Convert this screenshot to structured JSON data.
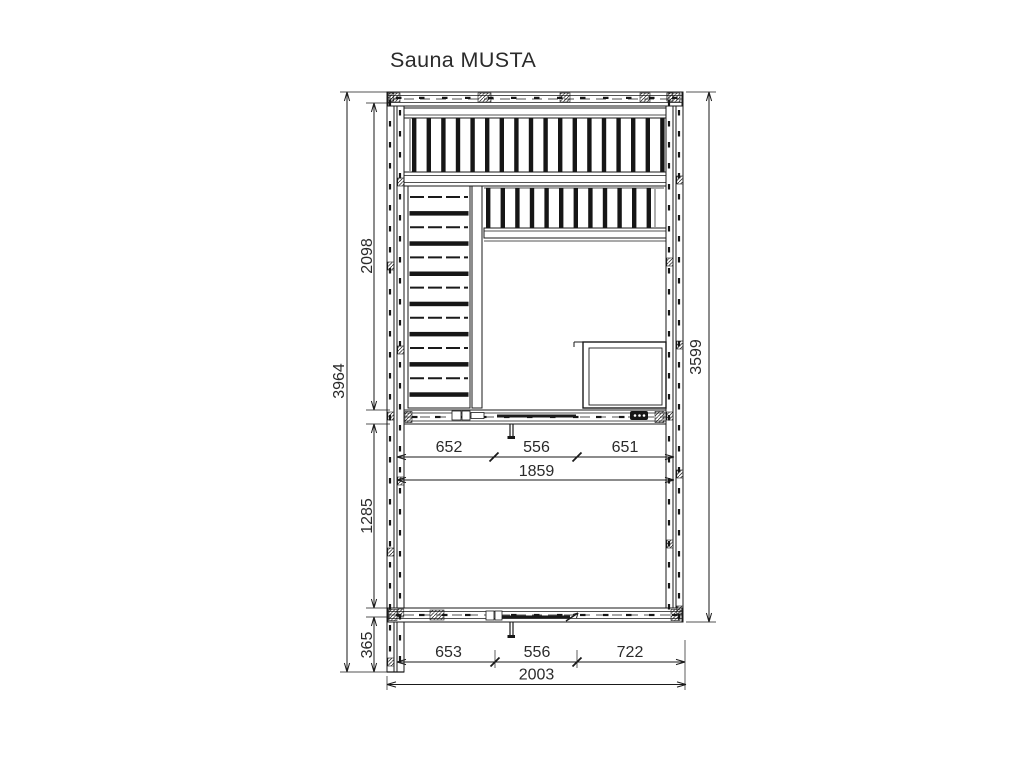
{
  "title": "Sauna MUSTA",
  "dims": {
    "overall_height": "3964",
    "upper_depth": "2098",
    "lower_depth": "1285",
    "overhang": "365",
    "right_height": "3599",
    "upper_widths": [
      "652",
      "556",
      "651"
    ],
    "upper_total": "1859",
    "lower_widths": [
      "653",
      "556",
      "722"
    ],
    "lower_total": "2003"
  },
  "colors": {
    "line": "#1a1a1a",
    "dark": "#161616",
    "text": "#2b2b2b",
    "bg": "#ffffff"
  }
}
